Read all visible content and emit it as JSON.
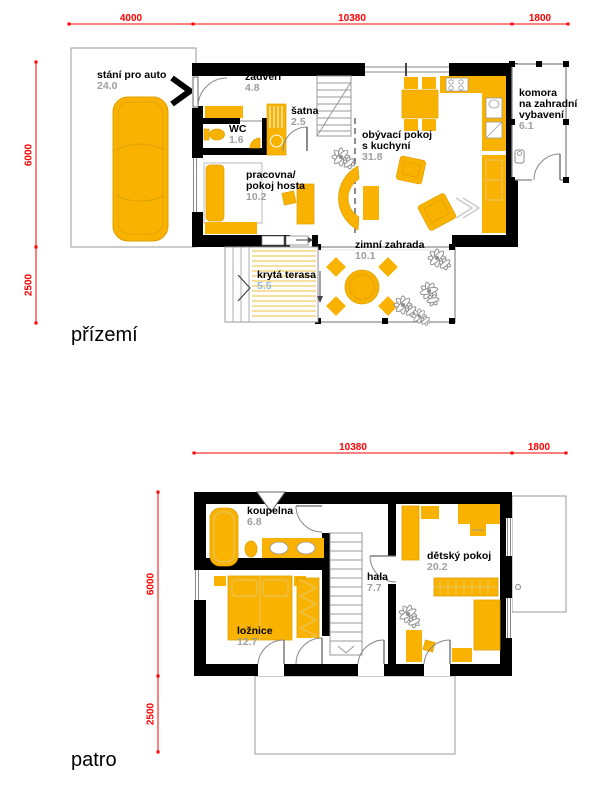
{
  "colors": {
    "furniture_yellow": "#F9B200",
    "stripe_yellow": "#F7DFA0",
    "dimension_red": "#FF0000",
    "area_gray": "#9E9E9E",
    "terrace_area_blue": "#9DB8D9",
    "wall_black": "#000000"
  },
  "ground": {
    "title": "přízemí",
    "dims": {
      "d4000": "4000",
      "d10380": "10380",
      "d1800": "1800",
      "d6000": "6000",
      "d2500": "2500"
    },
    "rooms": {
      "garage": {
        "line1": "stání pro auto",
        "area": "24.0"
      },
      "zadveri": {
        "line1": "zádveří",
        "area": "4.8"
      },
      "wc": {
        "line1": "WC",
        "area": "1.6"
      },
      "satna": {
        "line1": "šatna",
        "area": "2.5"
      },
      "pracovna": {
        "line1": "pracovna/",
        "line2": "pokoj hosta",
        "area": "10.2"
      },
      "obyvaci": {
        "line1": "obývací pokoj",
        "line2": "s kuchyní",
        "area": "31.8"
      },
      "komora": {
        "line1": "komora",
        "line2": "na zahradní",
        "line3": "vybavení",
        "area": "6.1"
      },
      "zimni": {
        "line1": "zimní zahrada",
        "area": "10.1"
      },
      "terasa": {
        "line1": "krytá terasa",
        "area": "5.5"
      }
    }
  },
  "upper": {
    "title": "patro",
    "dims": {
      "d10380": "10380",
      "d1800": "1800",
      "d6000": "6000",
      "d2500": "2500"
    },
    "rooms": {
      "koupelna": {
        "line1": "koupelna",
        "area": "6.8"
      },
      "loznice": {
        "line1": "ložnice",
        "area": "12.7"
      },
      "hala": {
        "line1": "hala",
        "area": "7.7"
      },
      "detsky": {
        "line1": "dětský pokoj",
        "area": "20.2"
      }
    }
  }
}
